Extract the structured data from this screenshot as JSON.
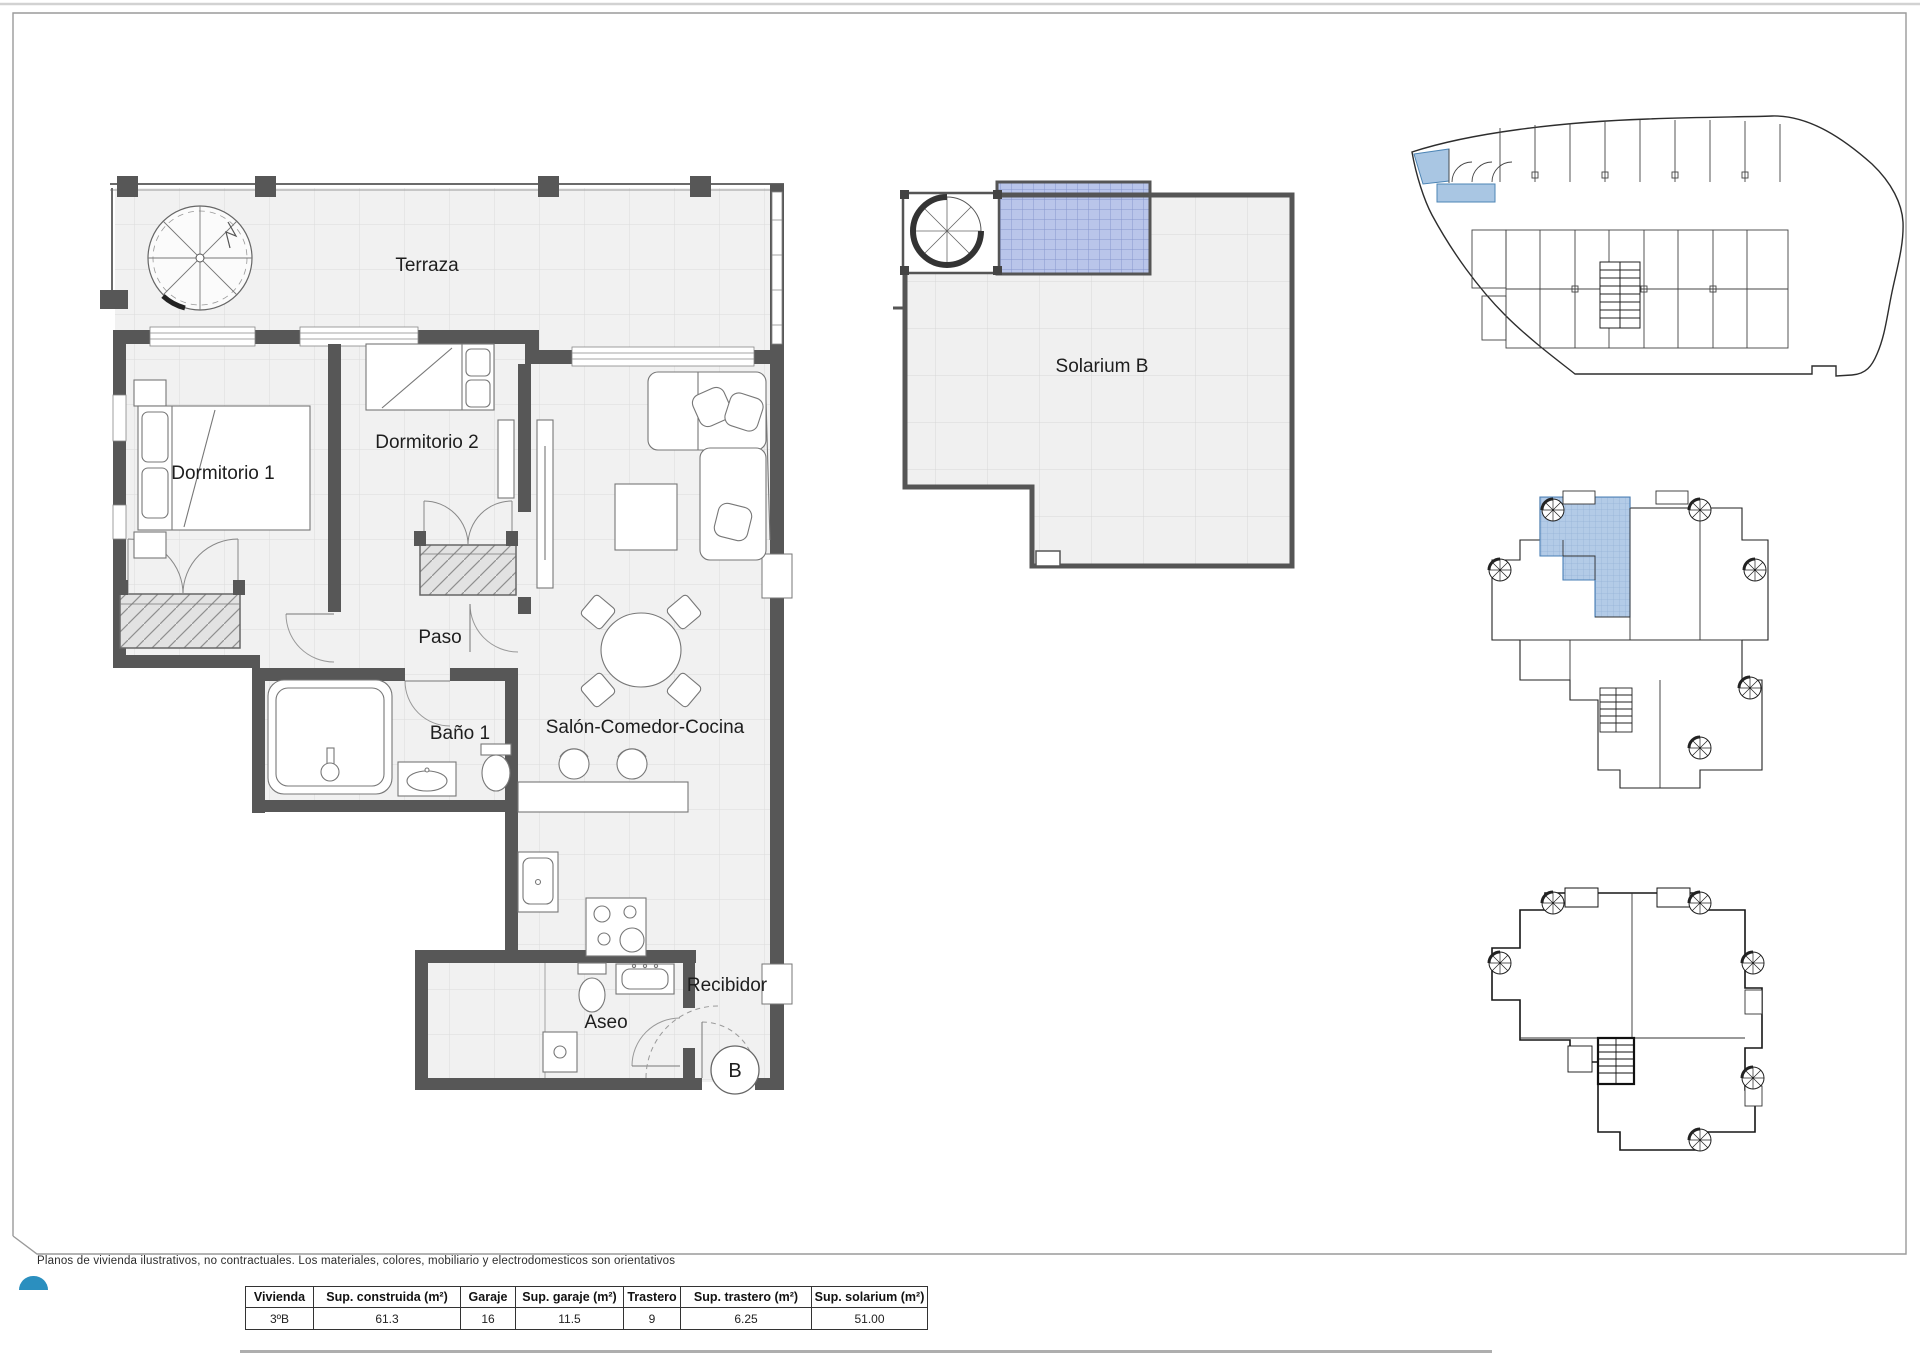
{
  "page": {
    "footer_note": "Planos de vivienda ilustrativos, no contractuales. Los materiales, colores, mobiliario y electrodomesticos son orientativos"
  },
  "main_plan": {
    "terraza": "Terraza",
    "dormitorio_1": "Dormitorio 1",
    "dormitorio_2": "Dormitorio 2",
    "paso": "Paso",
    "bano_1": "Baño 1",
    "salon": "Salón-Comedor-Cocina",
    "aseo": "Aseo",
    "recibidor": "Recibidor",
    "entrance_letter": "B"
  },
  "solarium_plan": {
    "label": "Solarium B"
  },
  "summary_table": {
    "columns": [
      "Vivienda",
      "Sup. construida (m²)",
      "Garaje",
      "Sup. garaje (m²)",
      "Trastero",
      "Sup. trastero (m²)",
      "Sup. solarium (m²)"
    ],
    "row": [
      "3ºB",
      "61.3",
      "16",
      "11.5",
      "9",
      "6.25",
      "51.00"
    ]
  },
  "colors": {
    "wall": "#575757",
    "floor": "#f1f1f1",
    "grid_line": "#dcdcdc",
    "highlight_blue": "#a9c6e3",
    "pergola_blue": "#b9c5ea",
    "logo_blue": "#2b8fbf"
  }
}
